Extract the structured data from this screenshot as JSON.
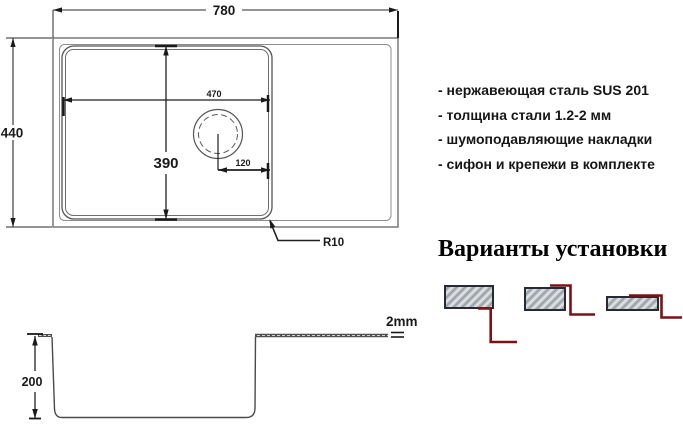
{
  "colors": {
    "accent_red": "#7d1216",
    "line_dark": "#2a2a2a",
    "line_gray": "#6f6f6f",
    "hatch_fill": "#b7bcc1",
    "text": "#161616"
  },
  "top_view": {
    "width": "780",
    "height": "440",
    "bowl_width": "470",
    "bowl_height": "390",
    "drain_offset": "120",
    "corner_radius": "R10"
  },
  "section_view": {
    "depth": "200",
    "thickness": "2mm"
  },
  "features": {
    "items": [
      "- нержавеющая сталь SUS 201",
      "- толщина стали 1.2-2 мм",
      "- шумоподавляющие накладки",
      "- сифон и крепежи в комплекте"
    ]
  },
  "installation": {
    "title": "Варианты установки",
    "variants": [
      {
        "name": "undermount"
      },
      {
        "name": "flush-mount"
      },
      {
        "name": "overmount"
      }
    ]
  }
}
